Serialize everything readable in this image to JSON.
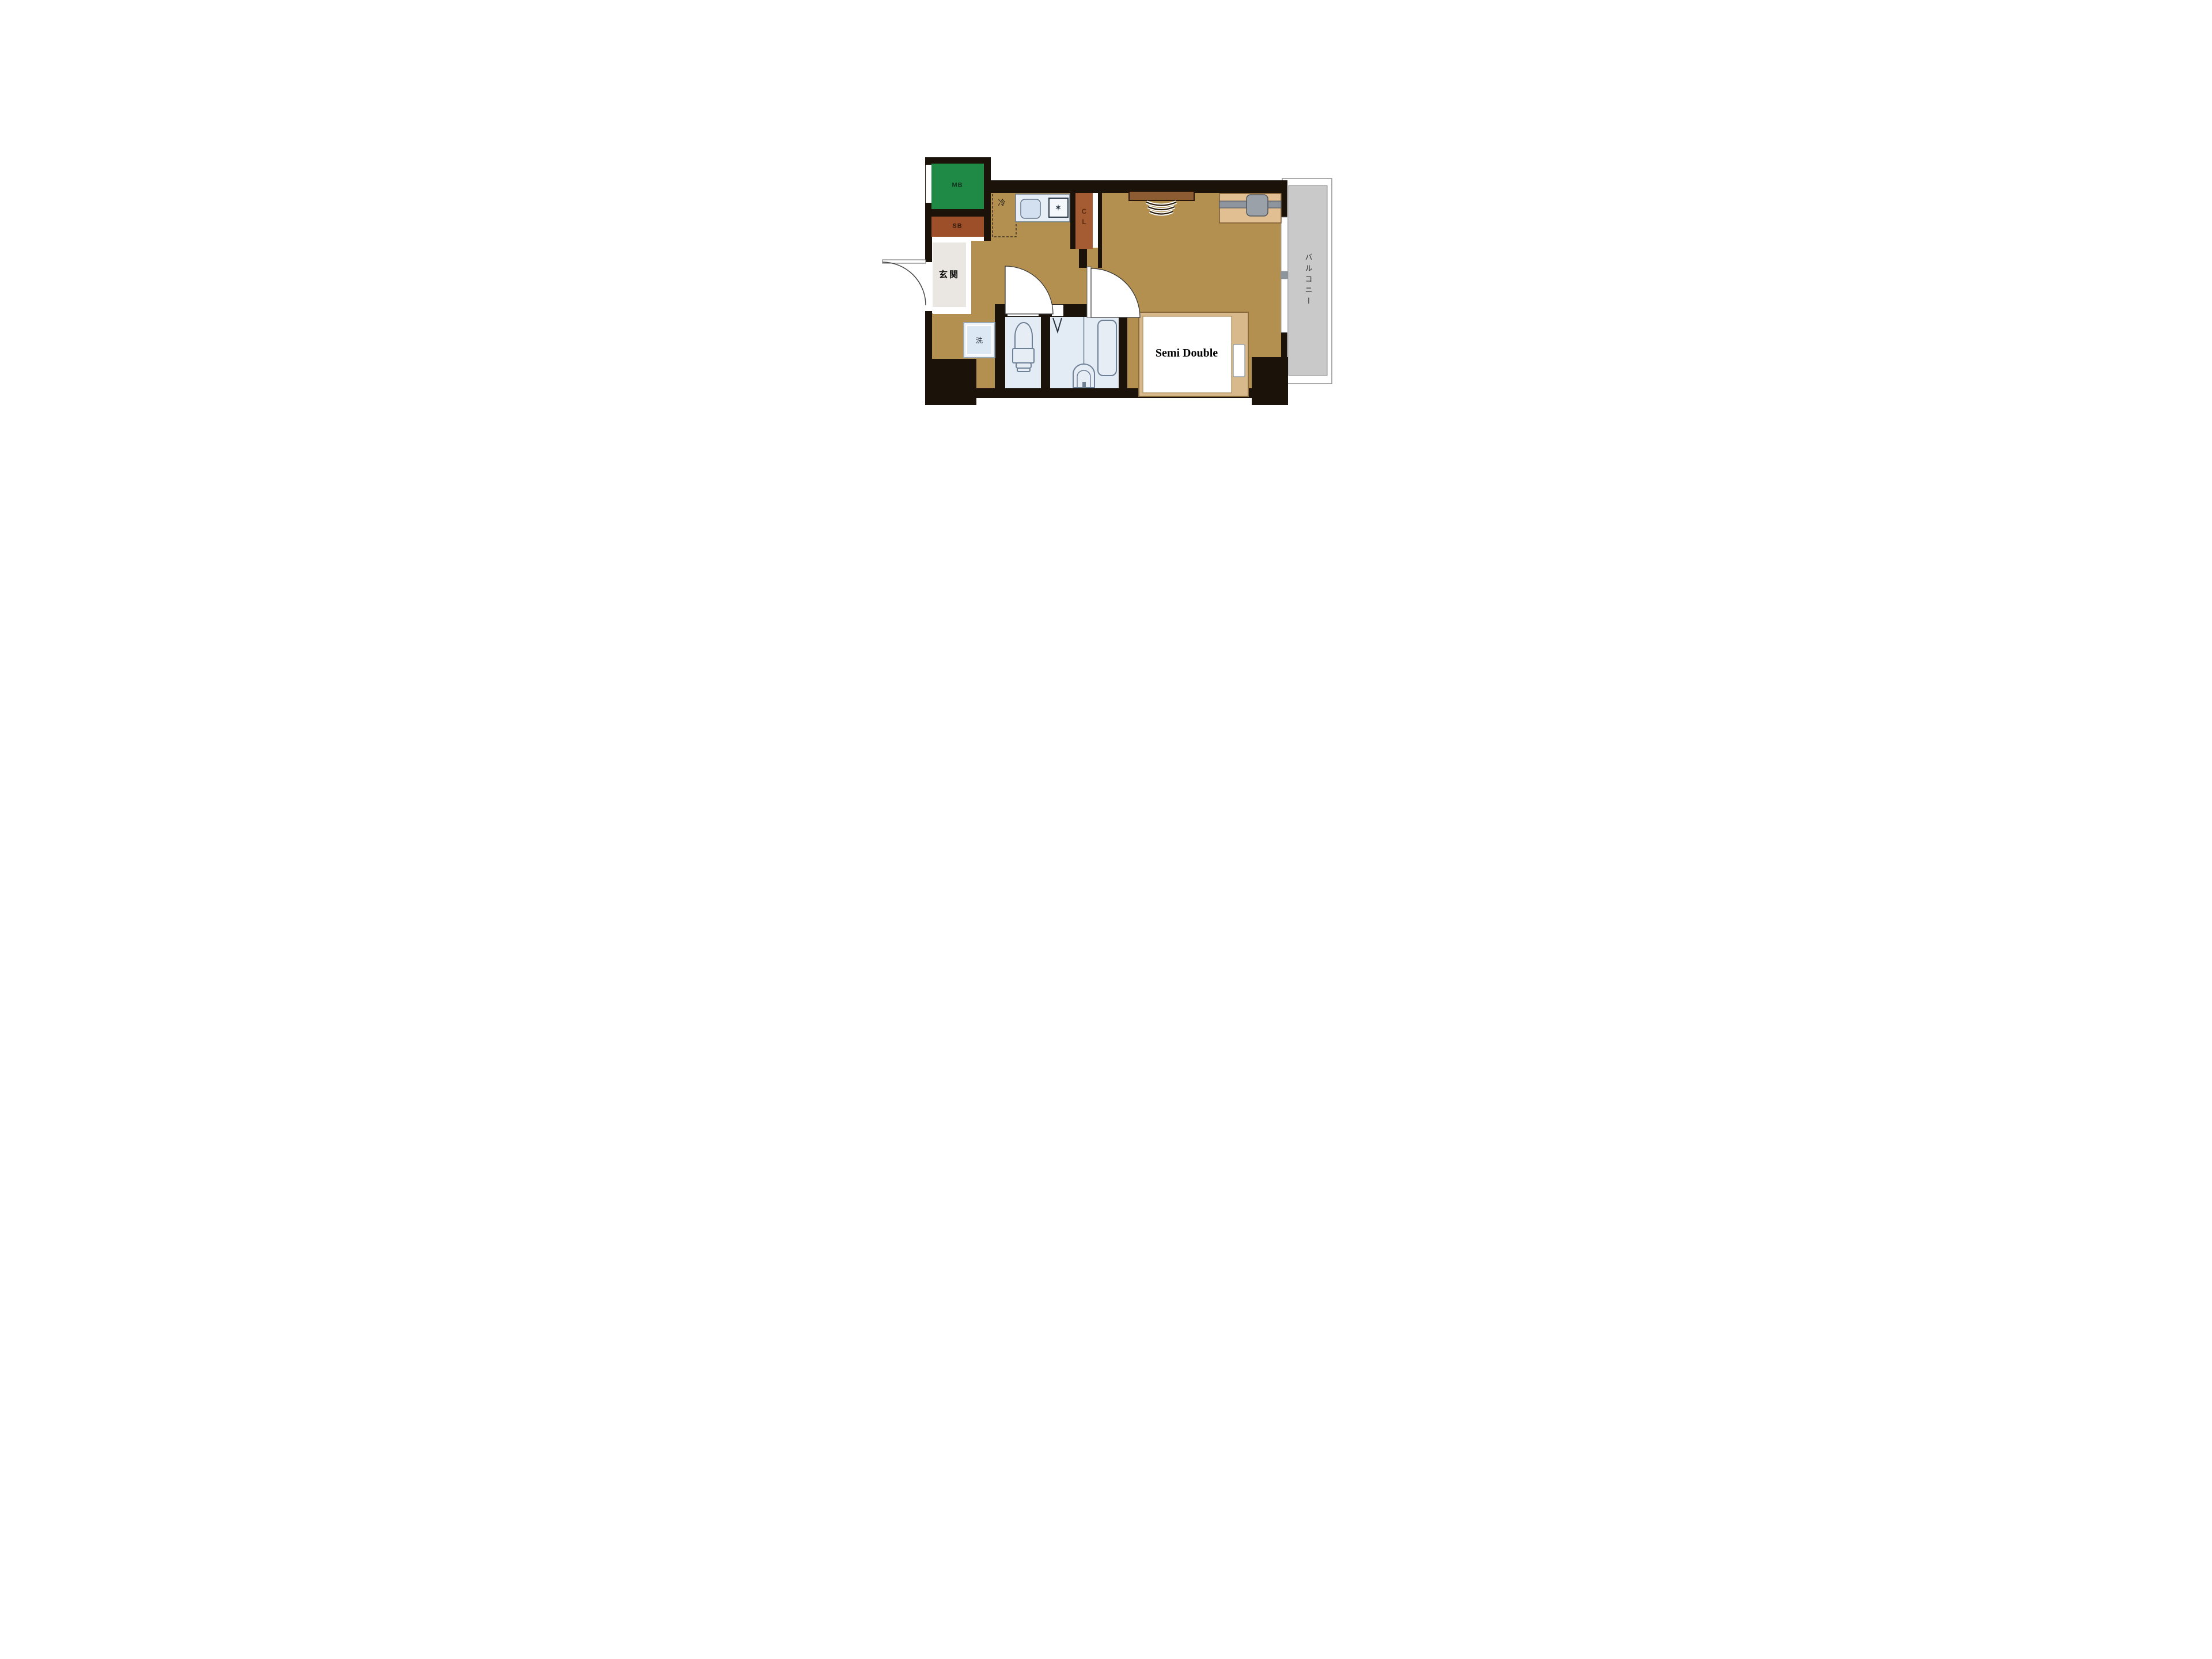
{
  "title": "1K apartment floor plan",
  "palette": {
    "wall": "#1b1209",
    "floor": "#b3904f",
    "mb_green": "#1f8a46",
    "sb_brown": "#9c4f28",
    "cl_brown": "#a55c32",
    "genkan_bg": "#eae7e2",
    "wet_room": "#e3ebf4",
    "counter": "#e7eef6",
    "balcony_gray": "#c9c9c9",
    "balcony_border": "#8f8f8f",
    "bed_frame": "#d7b98b",
    "desk_brown": "#8d5c33",
    "shelf_tan": "#e2bf92",
    "text_dark": "#1c1c1c"
  },
  "labels": {
    "meter_box": "MB",
    "shaft_box": "SB",
    "refrigerator": "冷",
    "closet": "CL",
    "entrance": "玄関",
    "washer": "洗",
    "balcony": "バルコニー",
    "bed": "Semi Double",
    "burner_icon": "✶"
  },
  "rooms": [
    {
      "name": "entrance",
      "label": "玄関"
    },
    {
      "name": "kitchen-hallway",
      "label": ""
    },
    {
      "name": "toilet",
      "label": ""
    },
    {
      "name": "bathroom",
      "label": ""
    },
    {
      "name": "main-room",
      "label": ""
    },
    {
      "name": "balcony",
      "label": "バルコニー"
    }
  ]
}
